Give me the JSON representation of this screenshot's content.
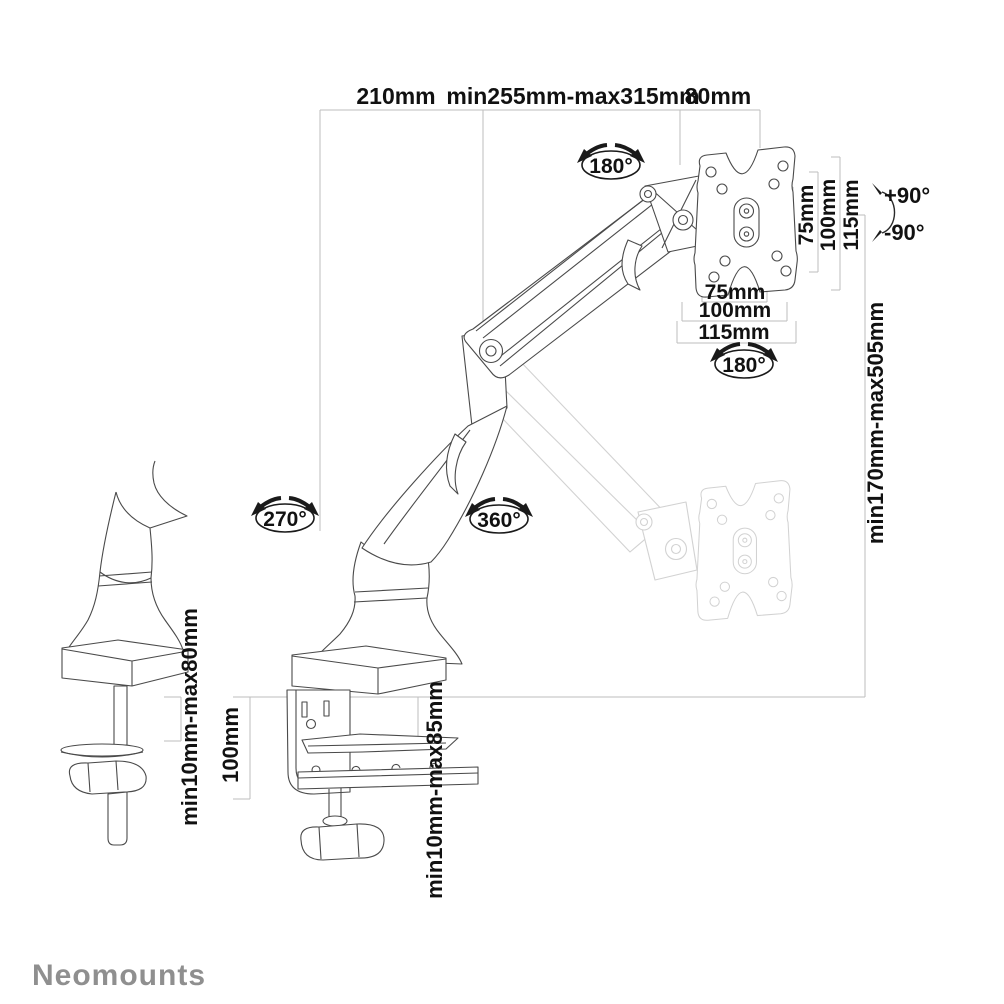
{
  "brand": {
    "name": "Neomounts",
    "color": "#8f8f8f"
  },
  "colors": {
    "background": "#ffffff",
    "line_art": "#4a4a4a",
    "ghost_position": "#d2d2d2",
    "dimension_lines": "#bdbdbd",
    "labels": "#111111"
  },
  "dimensions": {
    "top_spans": [
      {
        "label": "210mm"
      },
      {
        "label": "min255mm-max315mm"
      },
      {
        "label": "80mm"
      }
    ],
    "vesa_vertical": [
      {
        "label": "75mm"
      },
      {
        "label": "100mm"
      },
      {
        "label": "115mm"
      }
    ],
    "vesa_horizontal": [
      {
        "label": "75mm"
      },
      {
        "label": "100mm"
      },
      {
        "label": "115mm"
      }
    ],
    "height_range": {
      "label": "min170mm-max505mm"
    },
    "grommet_desk_thickness": {
      "label": "min10mm-max80mm"
    },
    "clamp_height": {
      "label": "100mm"
    },
    "clamp_desk_thickness": {
      "label": "min10mm-max85mm"
    }
  },
  "rotations": {
    "head_swivel": {
      "label": "180°"
    },
    "vesa_rotation": {
      "label": "180°"
    },
    "base_swivel": {
      "label": "270°"
    },
    "arm_swivel": {
      "label": "360°"
    },
    "tilt_up": {
      "label": "+90°"
    },
    "tilt_down": {
      "label": "-90°"
    }
  }
}
